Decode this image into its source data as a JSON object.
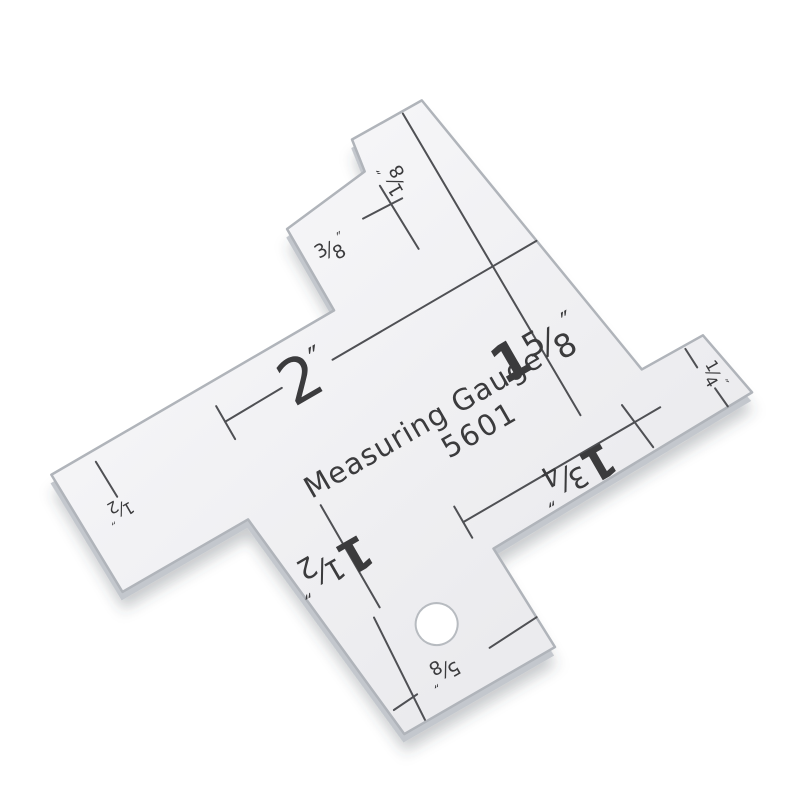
{
  "product": {
    "title": "Measuring Gauge",
    "model": "5601",
    "type_hint": "acrylic seam measuring gauge product photo",
    "measurements_visible": [
      "1/8″",
      "3/8″",
      "2″",
      "1 5/8″",
      "1/4″",
      "1/2″",
      "1 1/2″",
      "1 3/4″",
      "5/8″"
    ]
  },
  "colors": {
    "background": "#ffffff",
    "plate_light": "#f7f7f9",
    "plate_dark": "#ebebee",
    "edge_stroke": "#b0b4ba",
    "edge_face": "#c3c7cd",
    "shadow": "rgba(60,65,75,0.28)",
    "ink": "#3b3b3d",
    "rule_line": "#4f5054"
  },
  "gauge": {
    "rotation_deg": -30,
    "tx": -173.2,
    "ty": 99.8,
    "outline_points": [
      [
        435,
        297
      ],
      [
        515,
        298
      ],
      [
        571,
        641
      ],
      [
        641,
        642
      ],
      [
        655,
        716
      ],
      [
        353,
        722
      ],
      [
        357,
        838
      ],
      [
        183,
        838
      ],
      [
        155,
        574
      ],
      [
        10,
        574
      ],
      [
        7,
        437
      ],
      [
        334,
        436
      ],
      [
        334,
        342
      ],
      [
        430,
        331
      ]
    ],
    "hole": {
      "cx": 266,
      "cy": 759,
      "r": 21
    },
    "lines": [
      {
        "name": "eighth-and-1-5-8-rule-line",
        "x1": 492,
        "y1": 300,
        "x2": 495,
        "y2": 650
      },
      {
        "name": "three-eighths-line",
        "x1": 436,
        "y1": 351,
        "x2": 438,
        "y2": 425
      },
      {
        "name": "three-eighths-tick",
        "x1": 405,
        "y1": 371,
        "x2": 449,
        "y2": 373
      },
      {
        "name": "two-inch-line-left",
        "x1": 184,
        "y1": 478,
        "x2": 250,
        "y2": 477
      },
      {
        "name": "two-inch-line-right",
        "x1": 308,
        "y1": 478,
        "x2": 544,
        "y2": 477
      },
      {
        "name": "two-inch-tick",
        "x1": 184,
        "y1": 460,
        "x2": 184,
        "y2": 498
      },
      {
        "name": "half-inch-line",
        "x1": 52,
        "y1": 448,
        "x2": 53,
        "y2": 489
      },
      {
        "name": "one-three-quarter-line",
        "x1": 340,
        "y1": 684,
        "x2": 568,
        "y2": 683
      },
      {
        "name": "one-three-quarter-tick",
        "x1": 340,
        "y1": 666,
        "x2": 340,
        "y2": 702
      },
      {
        "name": "right-cross-line",
        "x1": 536,
        "y1": 662,
        "x2": 542,
        "y2": 714
      },
      {
        "name": "quarter-tick-top",
        "x1": 619,
        "y1": 645,
        "x2": 620,
        "y2": 667
      },
      {
        "name": "quarter-tick-bottom",
        "x1": 625,
        "y1": 694,
        "x2": 627,
        "y2": 716
      },
      {
        "name": "one-half-bottom-line",
        "x1": 225,
        "y1": 598,
        "x2": 225,
        "y2": 716
      },
      {
        "name": "arm-left-line",
        "x1": 215,
        "y1": 722,
        "x2": 208,
        "y2": 836
      },
      {
        "name": "five-eighths-line-right",
        "x1": 300,
        "y1": 806,
        "x2": 356,
        "y2": 803
      },
      {
        "name": "five-eighths-line-left",
        "x1": 186,
        "y1": 812,
        "x2": 214,
        "y2": 810
      }
    ],
    "dim_labels": [
      {
        "name": "label-1-8",
        "big": "",
        "num": "1",
        "den": "8",
        "x": 460,
        "y": 352,
        "rot": -90,
        "size": 30,
        "quote": "″"
      },
      {
        "name": "label-3-8",
        "big": "",
        "num": "3",
        "den": "8",
        "x": 363,
        "y": 390,
        "rot": 0,
        "size": 30,
        "quote": "″"
      },
      {
        "name": "label-2",
        "big": "2",
        "num": "",
        "den": "",
        "x": 276,
        "y": 500,
        "rot": 0,
        "size": 62,
        "quote": "″",
        "bold": false
      },
      {
        "name": "label-1-5-8",
        "big": "1",
        "num": "5",
        "den": "8",
        "x": 490,
        "y": 586,
        "rot": 0,
        "size": 52,
        "quote": "″",
        "bold": true
      },
      {
        "name": "label-1-4",
        "big": "",
        "num": "1",
        "den": "4",
        "x": 623,
        "y": 682,
        "rot": 90,
        "size": 26,
        "quote": "″"
      },
      {
        "name": "label-1-2",
        "big": "",
        "num": "1",
        "den": "2",
        "x": 48,
        "y": 494,
        "rot": 180,
        "size": 26,
        "quote": "″"
      },
      {
        "name": "label-1-1-2",
        "big": "1",
        "num": "1",
        "den": "2",
        "x": 205,
        "y": 642,
        "rot": 180,
        "size": 46,
        "quote": "″",
        "bold": true
      },
      {
        "name": "label-1-3-4",
        "big": "1",
        "num": "3",
        "den": "4",
        "x": 462,
        "y": 684,
        "rot": 180,
        "size": 46,
        "quote": "″",
        "bold": true
      },
      {
        "name": "label-5-8",
        "big": "",
        "num": "5",
        "den": "8",
        "x": 248,
        "y": 794,
        "rot": 180,
        "size": 30,
        "quote": "″"
      }
    ],
    "texts": [
      {
        "name": "product-title-text",
        "value": "Measuring Gauge",
        "x": 355,
        "y": 588,
        "size": 29,
        "spacing": 1
      },
      {
        "name": "product-model-text",
        "value": "5601",
        "x": 400,
        "y": 622,
        "size": 29,
        "spacing": 2
      }
    ]
  }
}
